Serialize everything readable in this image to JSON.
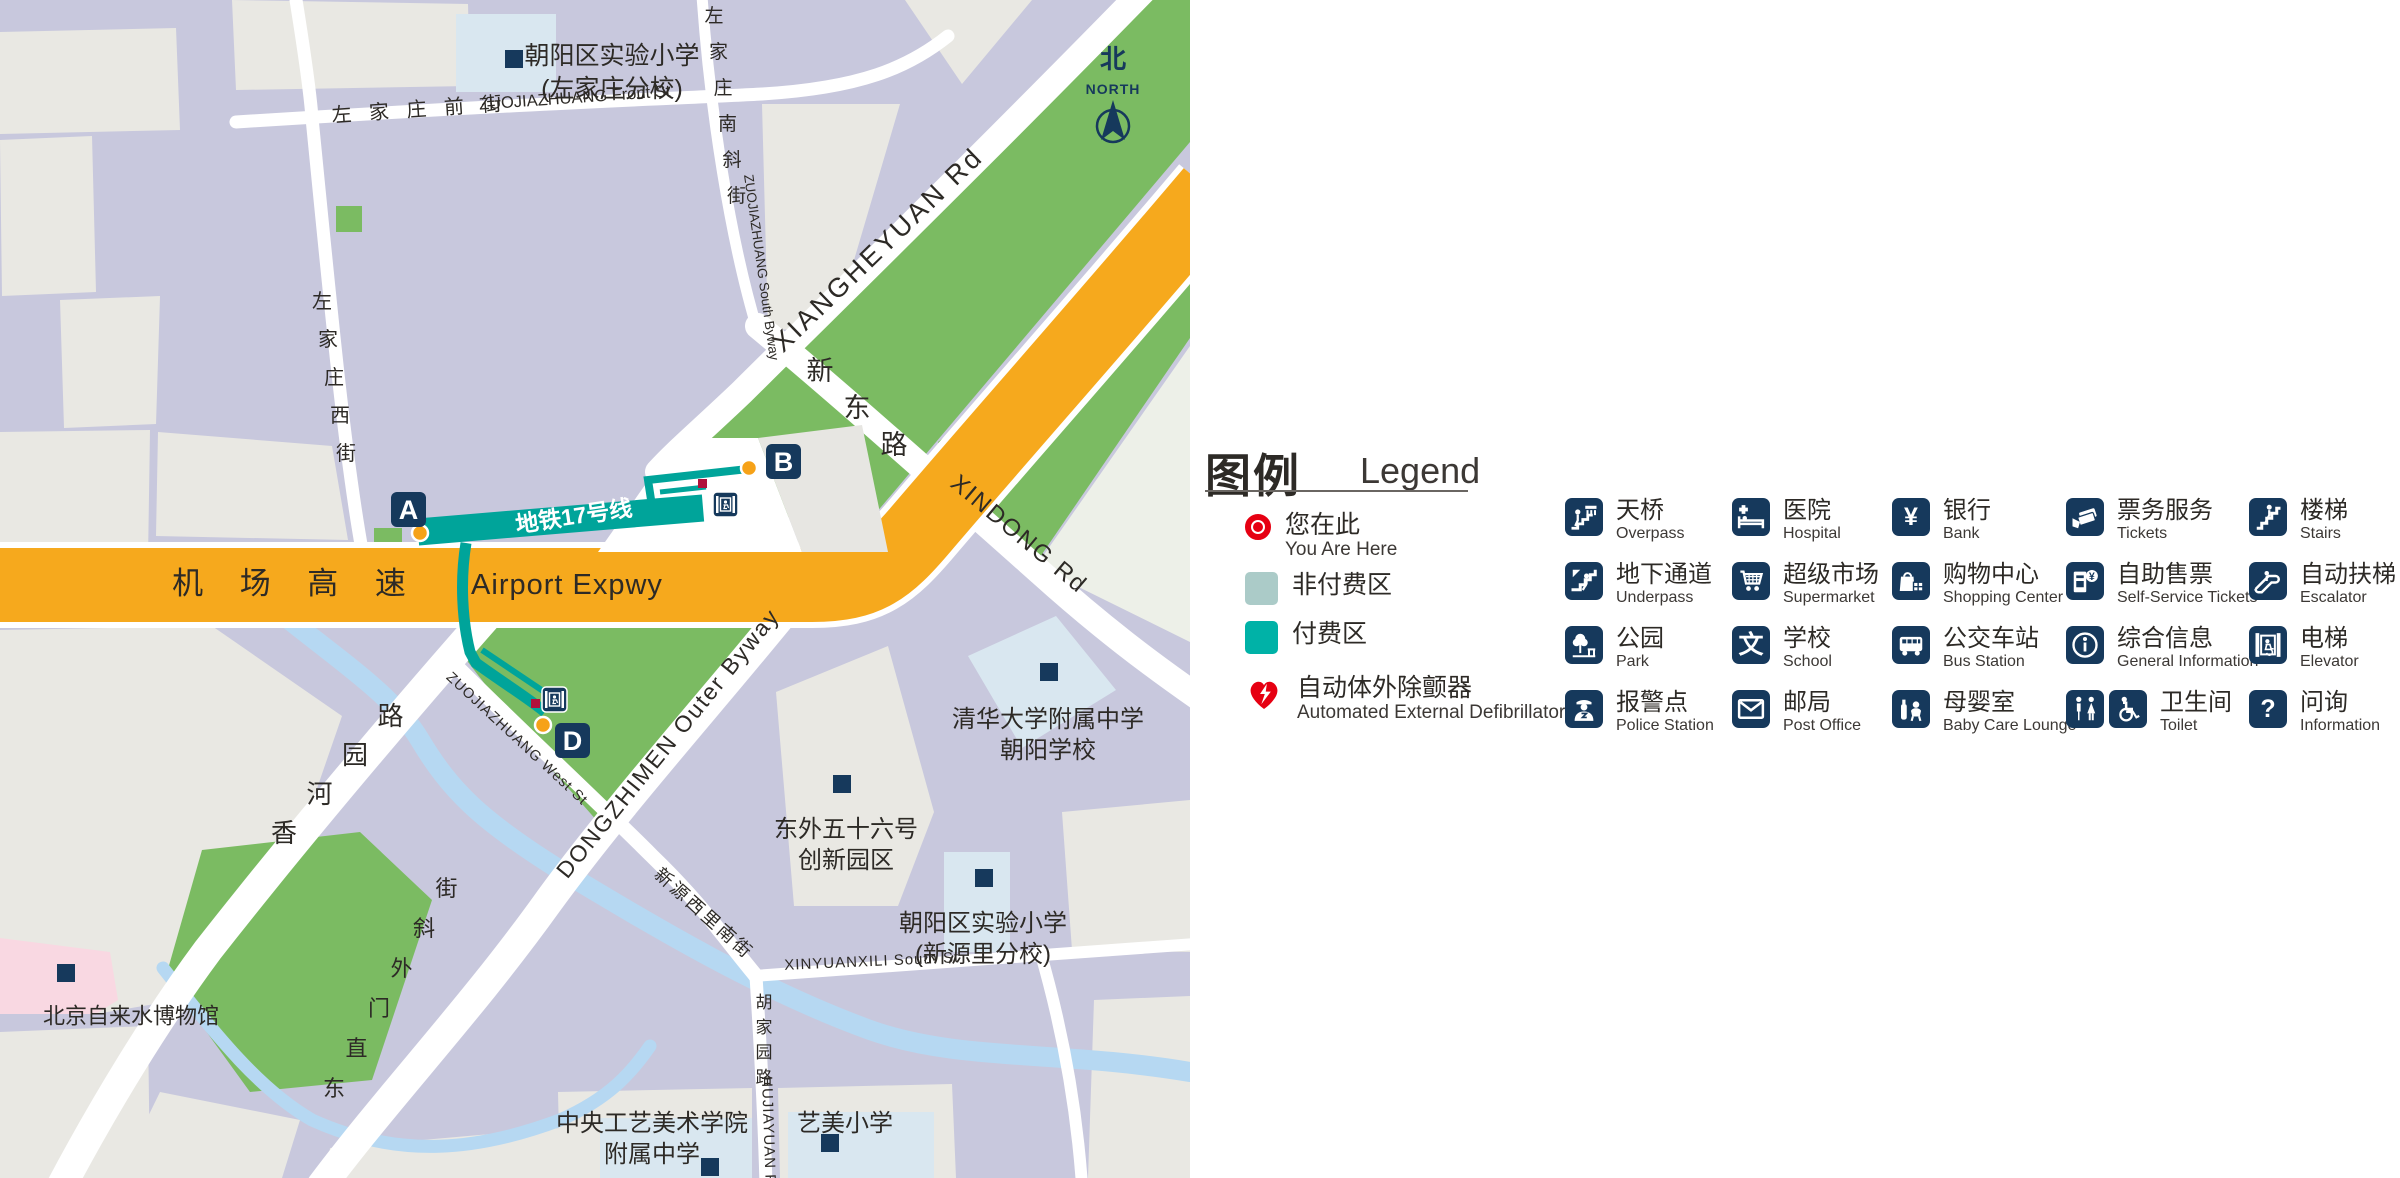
{
  "colors": {
    "lavender": "#c8c8dd",
    "block_gray": "#e9e8e3",
    "pale_green_gray": "#edf0e8",
    "school_blue": "#d9e7f0",
    "pink": "#f9d8e2",
    "park_green": "#7bbb62",
    "water": "#b6d8f2",
    "expressway_orange": "#f6a91d",
    "metro_teal": "#00a49a",
    "paid_teal": "#00b2a7",
    "unpaid_teal": "#abcbc8",
    "navy": "#16395c",
    "red": "#e60012",
    "aed_dot": "#b0123c",
    "exit_dot": "#f6a218",
    "label_dark": "#2d2a26"
  },
  "map": {
    "north": {
      "cn": "北",
      "en": "NORTH"
    },
    "station_label": {
      "t": "地铁17号线",
      "x": 575,
      "y": 524,
      "r": -8.5
    },
    "street_labels": [
      {
        "t": "左 家 庄 前 街",
        "x": 420,
        "y": 116,
        "r": -4,
        "s": 20,
        "ls": 6
      },
      {
        "t": "ZUOJIAZHUANG Front St",
        "x": 575,
        "y": 103,
        "r": -4,
        "s": 16.5,
        "ls": 0
      },
      {
        "t": "ZUOJIAZHUANG South Byway",
        "x": 757,
        "y": 268,
        "r": 82,
        "s": 13.5,
        "ls": 0
      },
      {
        "t": "XIANGHEYUAN Rd",
        "x": 884,
        "y": 256,
        "r": -44,
        "s": 27,
        "ls": 3
      },
      {
        "t": "XINDONG Rd",
        "x": 1014,
        "y": 540,
        "r": 40,
        "s": 24,
        "ls": 2
      },
      {
        "t": "机 场 高 速",
        "x": 296,
        "y": 594,
        "r": 0,
        "s": 31,
        "ls": 14
      },
      {
        "t": "Airport Expwy",
        "x": 567,
        "y": 594,
        "r": 0,
        "s": 29,
        "ls": 1
      },
      {
        "t": "DONGZHIMEN Outer Byway",
        "x": 674,
        "y": 748,
        "r": -51,
        "s": 23,
        "ls": 2
      },
      {
        "t": "ZUOJIAZHUANG West St",
        "x": 514,
        "y": 742,
        "r": 43,
        "s": 14.5,
        "ls": 1
      },
      {
        "t": "新源西里南街",
        "x": 700,
        "y": 918,
        "r": 42,
        "s": 18,
        "ls": 3
      },
      {
        "t": "XINYUANXILI South St",
        "x": 872,
        "y": 966,
        "r": -2.5,
        "s": 15,
        "ls": 1
      },
      {
        "t": "HUJIAYUAN Rd",
        "x": 764,
        "y": 1136,
        "r": 88,
        "s": 15,
        "ls": 1
      }
    ],
    "vchar_labels": [
      {
        "t": "左家庄西街",
        "x": 322,
        "y": 308,
        "dx": 6,
        "dy": 38,
        "s": 20
      },
      {
        "t": "左家庄南斜街",
        "x": 714,
        "y": 22,
        "dx": 4.5,
        "dy": 36,
        "s": 19
      },
      {
        "t": "新东路",
        "x": 820,
        "y": 380,
        "dx": 37,
        "dy": 37,
        "s": 27
      },
      {
        "t": "香河园路",
        "x": 284,
        "y": 842,
        "dx": 35.5,
        "dy": -39,
        "s": 26
      },
      {
        "t": "东直门外斜街",
        "x": 334,
        "y": 1096,
        "dx": 22.5,
        "dy": -40,
        "s": 22
      },
      {
        "t": "胡家园路",
        "x": 764,
        "y": 1008,
        "dx": 0,
        "dy": 25,
        "s": 17
      }
    ],
    "place_labels": [
      {
        "lines": [
          "朝阳区实验小学",
          "(左家庄分校)"
        ],
        "x": 612,
        "y": 44,
        "s": 25,
        "lh": 33,
        "poi": [
          505,
          50
        ]
      },
      {
        "lines": [
          "清华大学附属中学",
          "朝阳学校"
        ],
        "x": 1048,
        "y": 708,
        "s": 24,
        "lh": 31,
        "poi": [
          1040,
          663
        ]
      },
      {
        "lines": [
          "东外五十六号",
          "创新园区"
        ],
        "x": 846,
        "y": 818,
        "s": 24,
        "lh": 31,
        "poi": [
          833,
          775
        ]
      },
      {
        "lines": [
          "朝阳区实验小学",
          "(新源里分校)"
        ],
        "x": 983,
        "y": 912,
        "s": 24,
        "lh": 31,
        "poi": [
          975,
          869
        ]
      },
      {
        "lines": [
          "北京自来水博物馆"
        ],
        "x": 131,
        "y": 1006,
        "s": 22,
        "lh": 26,
        "poi": [
          57,
          964
        ]
      },
      {
        "lines": [
          "中央工艺美术学院",
          "附属中学"
        ],
        "x": 652,
        "y": 1112,
        "s": 24,
        "lh": 31,
        "poi": [
          701,
          1158
        ]
      },
      {
        "lines": [
          "艺美小学"
        ],
        "x": 845,
        "y": 1112,
        "s": 24,
        "lh": 30,
        "poi": [
          821,
          1134
        ]
      }
    ],
    "exits": [
      {
        "id": "A",
        "box": [
          391,
          492
        ],
        "dot": [
          420,
          533
        ]
      },
      {
        "id": "B",
        "box": [
          766,
          444
        ],
        "dot": [
          749,
          468
        ]
      },
      {
        "id": "D",
        "box": [
          555,
          723
        ],
        "dot": [
          543,
          725
        ]
      }
    ],
    "elevator_points": [
      [
        713,
        492
      ],
      [
        542,
        687
      ]
    ],
    "aed_points": [
      [
        698,
        479
      ],
      [
        531,
        699
      ]
    ]
  },
  "legend": {
    "title_cn": "图例",
    "title_en": "Legend",
    "items": [
      {
        "icon": "you-are-here-marker",
        "cn": "您在此",
        "en": "You Are Here"
      },
      {
        "icon": "unpaid-area-swatch",
        "cn": "非付费区",
        "en": ""
      },
      {
        "icon": "paid-area-swatch",
        "cn": "付费区",
        "en": ""
      },
      {
        "icon": "aed-heart",
        "cn": "自动体外除颤器",
        "en": "Automated External Defibrillator"
      }
    ],
    "grid": [
      {
        "icon": "overpass",
        "cn": "天桥",
        "en": "Overpass",
        "col": 0,
        "row": 0
      },
      {
        "icon": "hospital",
        "cn": "医院",
        "en": "Hospital",
        "col": 1,
        "row": 0
      },
      {
        "icon": "bank",
        "cn": "银行",
        "en": "Bank",
        "col": 2,
        "row": 0
      },
      {
        "icon": "tickets",
        "cn": "票务服务",
        "en": "Tickets",
        "col": 3,
        "row": 0
      },
      {
        "icon": "stairs",
        "cn": "楼梯",
        "en": "Stairs",
        "col": 4,
        "row": 0
      },
      {
        "icon": "underpass",
        "cn": "地下通道",
        "en": "Underpass",
        "col": 0,
        "row": 1
      },
      {
        "icon": "supermarket",
        "cn": "超级市场",
        "en": "Supermarket",
        "col": 1,
        "row": 1
      },
      {
        "icon": "shopping-center",
        "cn": "购物中心",
        "en": "Shopping Center",
        "col": 2,
        "row": 1
      },
      {
        "icon": "self-service-tickets",
        "cn": "自助售票",
        "en": "Self-Service Tickets",
        "col": 3,
        "row": 1
      },
      {
        "icon": "escalator",
        "cn": "自动扶梯",
        "en": "Escalator",
        "col": 4,
        "row": 1
      },
      {
        "icon": "park",
        "cn": "公园",
        "en": "Park",
        "col": 0,
        "row": 2
      },
      {
        "icon": "school",
        "cn": "学校",
        "en": "School",
        "col": 1,
        "row": 2
      },
      {
        "icon": "bus-station",
        "cn": "公交车站",
        "en": "Bus Station",
        "col": 2,
        "row": 2
      },
      {
        "icon": "general-information",
        "cn": "综合信息",
        "en": "General Information",
        "col": 3,
        "row": 2
      },
      {
        "icon": "elevator",
        "cn": "电梯",
        "en": "Elevator",
        "col": 4,
        "row": 2
      },
      {
        "icon": "police-station",
        "cn": "报警点",
        "en": "Police Station",
        "col": 0,
        "row": 3
      },
      {
        "icon": "post-office",
        "cn": "邮局",
        "en": "Post Office",
        "col": 1,
        "row": 3
      },
      {
        "icon": "baby-care-lounge",
        "cn": "母婴室",
        "en": "Baby Care Lounge",
        "col": 2,
        "row": 3
      },
      {
        "icon": "toilet",
        "icons": [
          "toilet-mf",
          "toilet-accessible"
        ],
        "cn": "卫生间",
        "en": "Toilet",
        "col": 3,
        "row": 3
      },
      {
        "icon": "information-question",
        "cn": "问询",
        "en": "Information",
        "col": 4,
        "row": 3
      }
    ]
  }
}
